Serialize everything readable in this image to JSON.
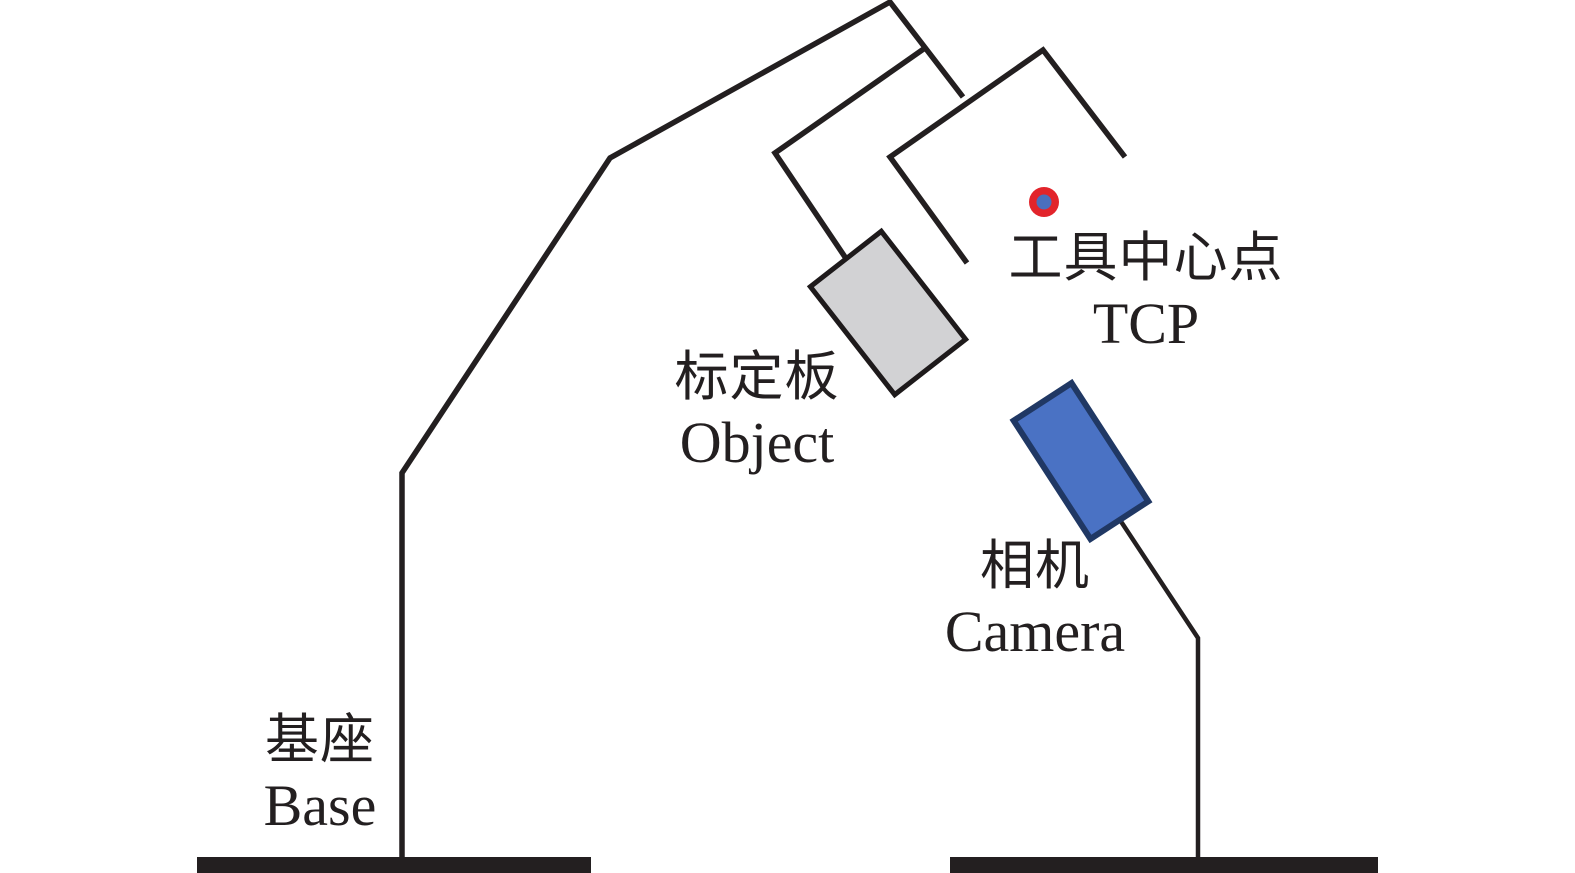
{
  "labels": {
    "tcp": {
      "zh": "工具中心点",
      "en": "TCP"
    },
    "board": {
      "zh": "标定板",
      "en": "Object"
    },
    "camera": {
      "zh": "相机",
      "en": "Camera"
    },
    "base": {
      "zh": "基座",
      "en": "Base"
    }
  },
  "colors": {
    "background": "#ffffff",
    "ink": "#231f20",
    "board_fill": "#d2d2d4",
    "board_stroke": "#1e1a1b",
    "camera_fill": "#4a72c4",
    "camera_stroke": "#203864",
    "tcp_outer": "#e2242b",
    "tcp_inner": "#4a6fbe"
  }
}
